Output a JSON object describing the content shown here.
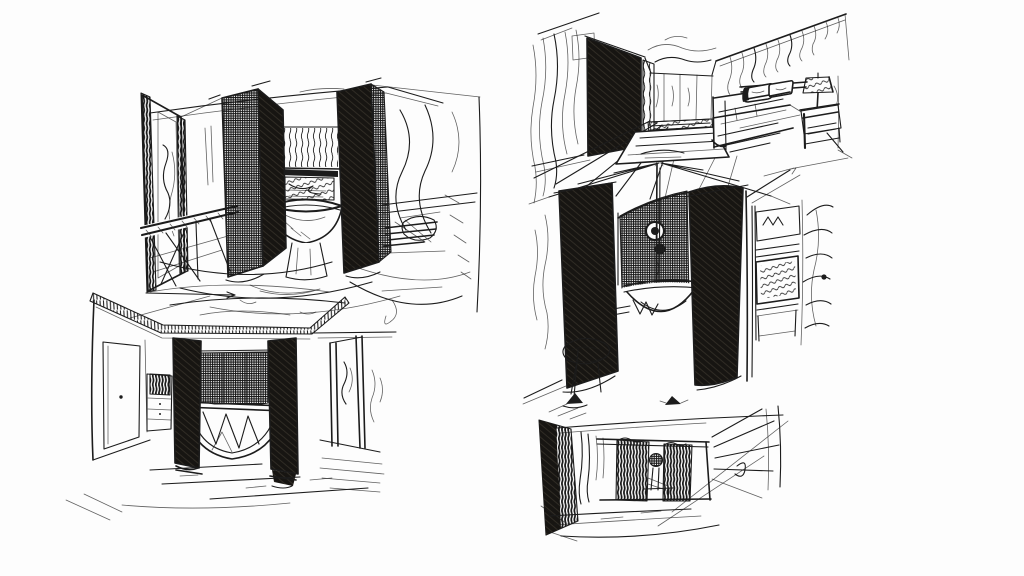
{
  "canvas": {
    "paper": "#fdfdfd",
    "ink": "#1c1c1c",
    "width": 1024,
    "height": 576
  },
  "figure": {
    "kind": "Hand-drawn interior design concept sketches, black ink pen on white paper",
    "sketch_count": 5,
    "sketches": [
      {
        "id": "corridor-bath",
        "position": "top-left",
        "label": "Perspective of a corridor-like bathroom: tall framed mirror and console table at left, two dark cross-hatched screen panels flanking a striped alcove with a round freestanding basin, scribbled fixtures on the right wall"
      },
      {
        "id": "bedroom-tub",
        "position": "bottom-left",
        "label": "Room elevation with hatched cove cornice, door and drawer cabinet on the left wall, two solid dark pillars with gridded screen and a semicircular tub between them, panelled door at right"
      },
      {
        "id": "bedroom-perspective",
        "position": "top-right",
        "label": "One-point perspective bedroom: curtained wall and dark wardrobe at left, panelled back wall with rug, bed with two pillows, shaded table lamp and nightstand at right"
      },
      {
        "id": "shower-enclosure",
        "position": "middle-right",
        "label": "Close-up of a curved screen enclosure: radiating ceiling lines, two open dark panels, central pole with round shower head over a bowl tub, stool and floor lamp at left, shelving and foliage at right"
      },
      {
        "id": "room-vignette",
        "position": "bottom-right",
        "label": "Small room vignette: pendant lamp, dark hatched left wall, two dark panels on the back wall with a pedestal washstand between them, radiating window lines at right"
      }
    ]
  }
}
